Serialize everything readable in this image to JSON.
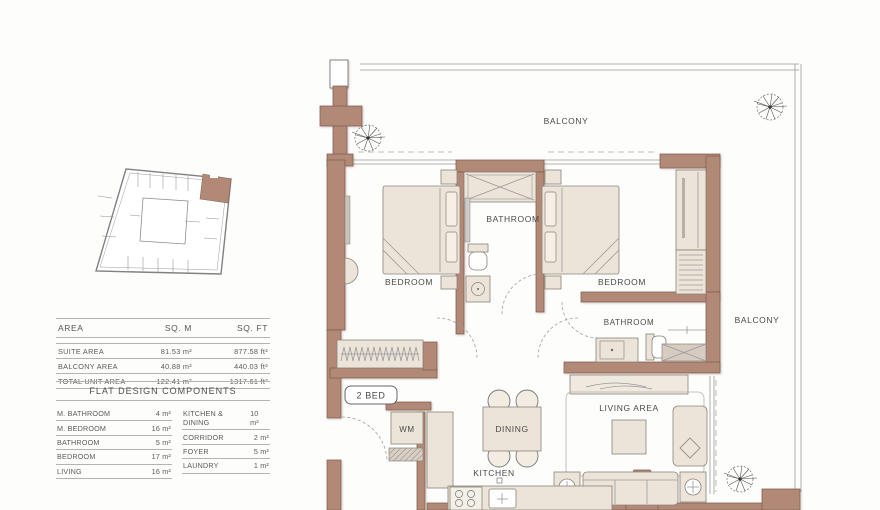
{
  "theme": {
    "wall": "#b28877",
    "wall-edge": "#7d5a4c",
    "furn": "#ece4d8",
    "ink": "#4a4a4a"
  },
  "area_table": {
    "headers": [
      "AREA",
      "SQ. M",
      "SQ. FT"
    ],
    "rows": [
      {
        "label": "SUITE AREA",
        "sqm": "81.53 m²",
        "sqft": "877.58 ft²"
      },
      {
        "label": "BALCONY AREA",
        "sqm": "40.88 m²",
        "sqft": "440.03 ft²"
      },
      {
        "label": "TOTAL UNIT AREA",
        "sqm": "122.41 m²",
        "sqft": "1317.61 ft²"
      }
    ]
  },
  "components": {
    "title": "FLAT DESIGN COMPONENTS",
    "left": [
      [
        "M. BATHROOM",
        "4 m²"
      ],
      [
        "M. BEDROOM",
        "16 m²"
      ],
      [
        "BATHROOM",
        "5 m²"
      ],
      [
        "BEDROOM",
        "17 m²"
      ],
      [
        "LIVING",
        "16 m²"
      ]
    ],
    "right": [
      [
        "KITCHEN & DINING",
        "10 m²"
      ],
      [
        "CORRIDOR",
        "2 m²"
      ],
      [
        "FOYER",
        "5 m²"
      ],
      [
        "LAUNDRY",
        "1 m²"
      ]
    ]
  },
  "plan": {
    "labels": {
      "balcony_top": "BALCONY",
      "balcony_right": "BALCONY",
      "bedroom_left": "BEDROOM",
      "bedroom_right": "BEDROOM",
      "bathroom_center": "BATHROOM",
      "bathroom_right": "BATHROOM",
      "living": "LIVING AREA",
      "dining": "DINING",
      "kitchen": "KITCHEN",
      "wm": "WM",
      "unit_badge": "2 BED"
    }
  }
}
